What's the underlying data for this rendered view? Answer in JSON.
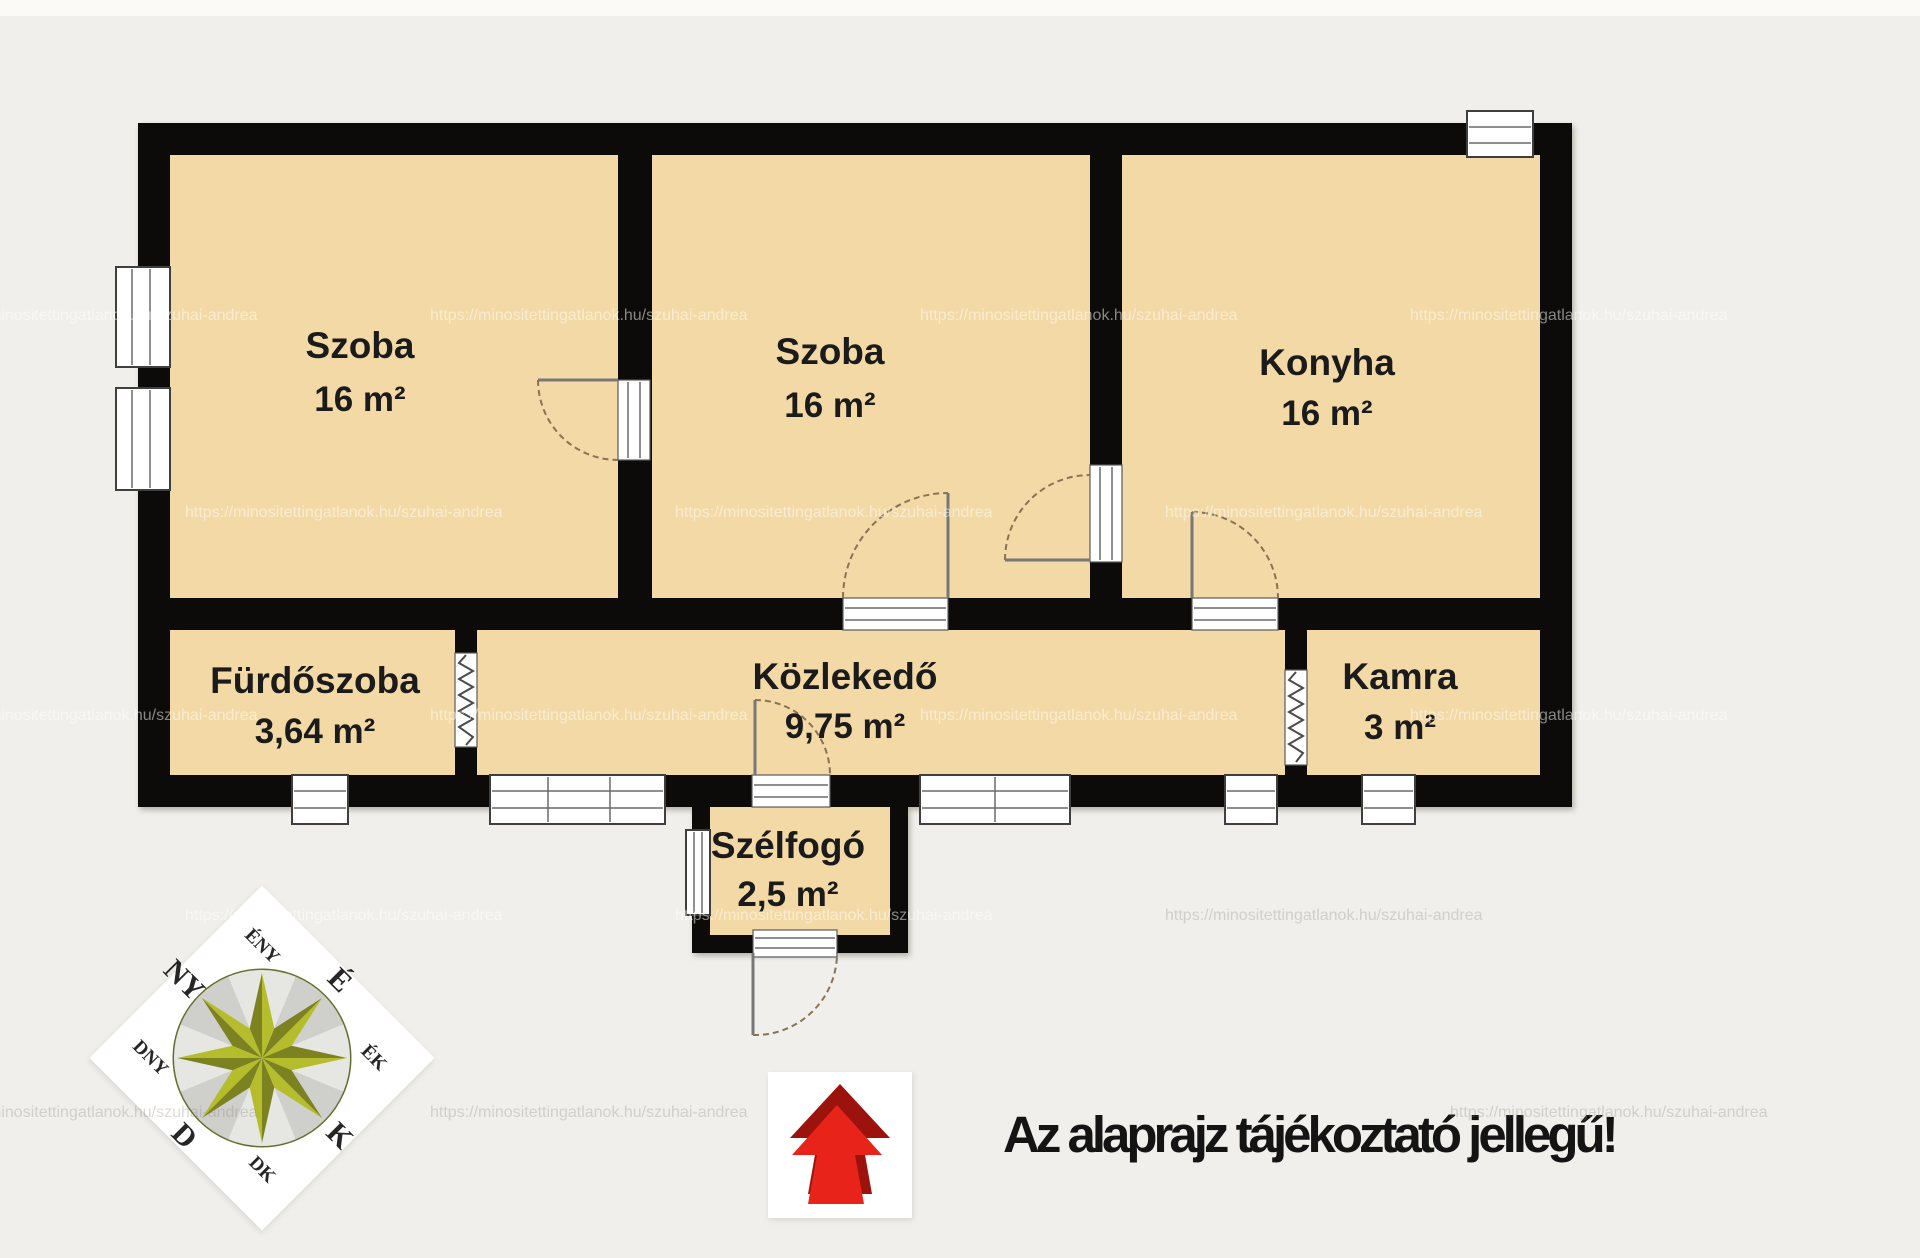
{
  "plan": {
    "rooms": [
      {
        "name": "Szoba",
        "area": "16 m²"
      },
      {
        "name": "Szoba",
        "area": "16 m²"
      },
      {
        "name": "Konyha",
        "area": "16 m²"
      },
      {
        "name": "Fürdőszoba",
        "area": "3,64 m²"
      },
      {
        "name": "Közlekedő",
        "area": "9,75 m²"
      },
      {
        "name": "Kamra",
        "area": "3 m²"
      },
      {
        "name": "Szélfogó",
        "area": "2,5 m²"
      }
    ]
  },
  "compass": {
    "labels": {
      "n": "É",
      "ne": "ÉK",
      "e": "K",
      "se": "DK",
      "s": "D",
      "sw": "DNY",
      "w": "NY",
      "nw": "ÉNY"
    }
  },
  "footer": {
    "disclaimer": "Az alaprajz tájékoztató jellegű!"
  },
  "watermark": {
    "text": "https://minositettingatlanok.hu/szuhai-andrea"
  },
  "colors": {
    "background": "#f0efeb",
    "floor": "#f3d9a5",
    "wall": "#0c0b09",
    "compass_star_light": "#b6bd2c",
    "compass_star_dark": "#7c8220",
    "arrow_red": "#e8231a",
    "arrow_dark_red": "#9c120d",
    "label_text": "#1b1b1b"
  }
}
